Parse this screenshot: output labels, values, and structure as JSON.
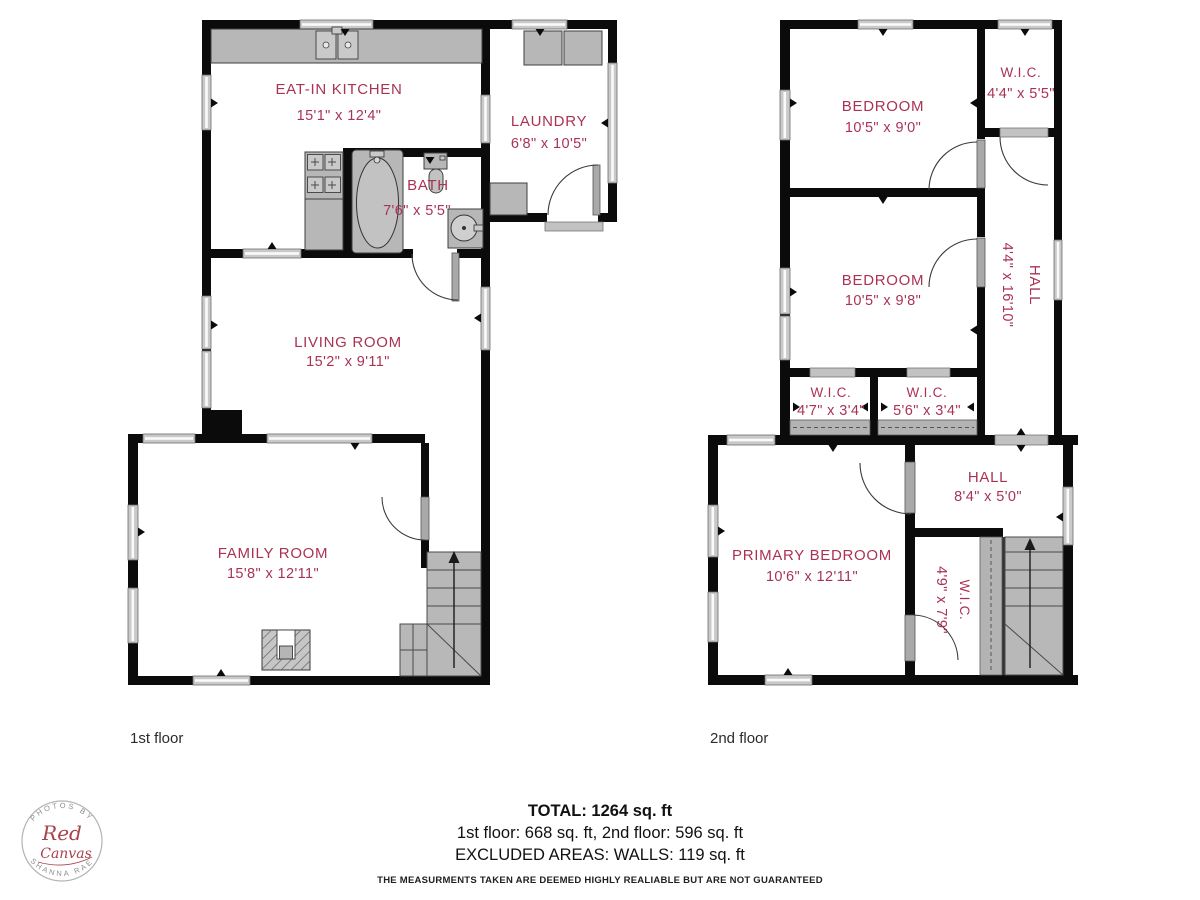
{
  "colors": {
    "wall": "#0b0b0b",
    "room_label": "#a93354",
    "fixture_gray": "#b7b7b7",
    "window_gray": "#c9c9c9",
    "logo_red": "#a8434b"
  },
  "floor1": {
    "label": "1st floor",
    "rooms": [
      {
        "name": "EAT-IN KITCHEN",
        "dims": "15'1\" x 12'4\""
      },
      {
        "name": "LAUNDRY",
        "dims": "6'8\" x 10'5\""
      },
      {
        "name": "BATH",
        "dims": "7'6\" x 5'5\""
      },
      {
        "name": "LIVING ROOM",
        "dims": "15'2\" x 9'11\""
      },
      {
        "name": "FAMILY ROOM",
        "dims": "15'8\" x 12'11\""
      }
    ]
  },
  "floor2": {
    "label": "2nd floor",
    "rooms": [
      {
        "name": "BEDROOM",
        "dims": "10'5\" x 9'0\""
      },
      {
        "name": "W.I.C.",
        "dims": "4'4\" x 5'5\""
      },
      {
        "name": "BEDROOM",
        "dims": "10'5\" x 9'8\""
      },
      {
        "name": "HALL",
        "dims": "4'4\" x 16'10\""
      },
      {
        "name": "W.I.C.",
        "dims": "4'7\" x 3'4\""
      },
      {
        "name": "W.I.C.",
        "dims": "5'6\" x 3'4\""
      },
      {
        "name": "HALL",
        "dims": "8'4\" x 5'0\""
      },
      {
        "name": "PRIMARY BEDROOM",
        "dims": "10'6\" x 12'11\""
      },
      {
        "name": "W.I.C.",
        "dims": "4'9\" x 7'9\""
      }
    ]
  },
  "summary": {
    "total": "TOTAL: 1264 sq. ft",
    "floors": "1st floor: 668 sq. ft, 2nd floor: 596 sq. ft",
    "excluded": "EXCLUDED AREAS: WALLS: 119 sq. ft",
    "disclaimer": "THE MEASURMENTS TAKEN ARE DEEMED HIGHLY REALIABLE BUT ARE NOT GUARANTEED"
  },
  "logo": {
    "top": "PHOTOS BY",
    "script1": "Red",
    "script2": "Canvas",
    "bottom": "SHANNA RAE"
  }
}
